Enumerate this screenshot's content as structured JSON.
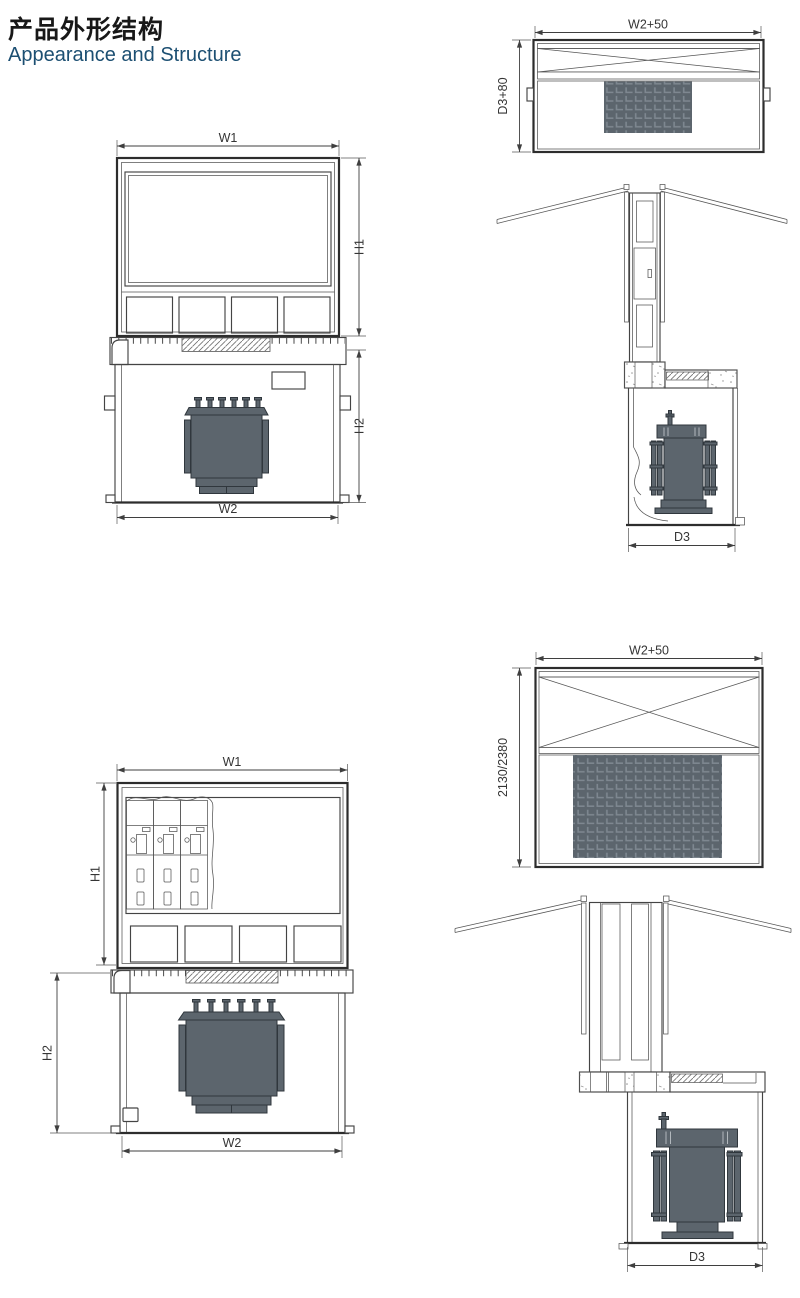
{
  "header": {
    "title_zh": "产品外形结构",
    "title_en": "Appearance and Structure"
  },
  "colors": {
    "title_en_blue": "#1c4f72",
    "line_dark": "#2d2d2d",
    "line_medium": "#444444",
    "transformer_fill": "#5c656d",
    "pattern_gray": "#ababab"
  },
  "views": {
    "front1": {
      "w1": "W1",
      "h1": "H1",
      "h2": "H2",
      "w2": "W2"
    },
    "top1": {
      "w": "W2+50",
      "d": "D3+80"
    },
    "side1": {
      "d": "D3"
    },
    "front2": {
      "w1": "W1",
      "h1": "H1",
      "h2": "H2",
      "w2": "W2"
    },
    "top2": {
      "w": "W2+50",
      "h": "2130/2380"
    },
    "side2": {
      "d": "D3"
    }
  }
}
